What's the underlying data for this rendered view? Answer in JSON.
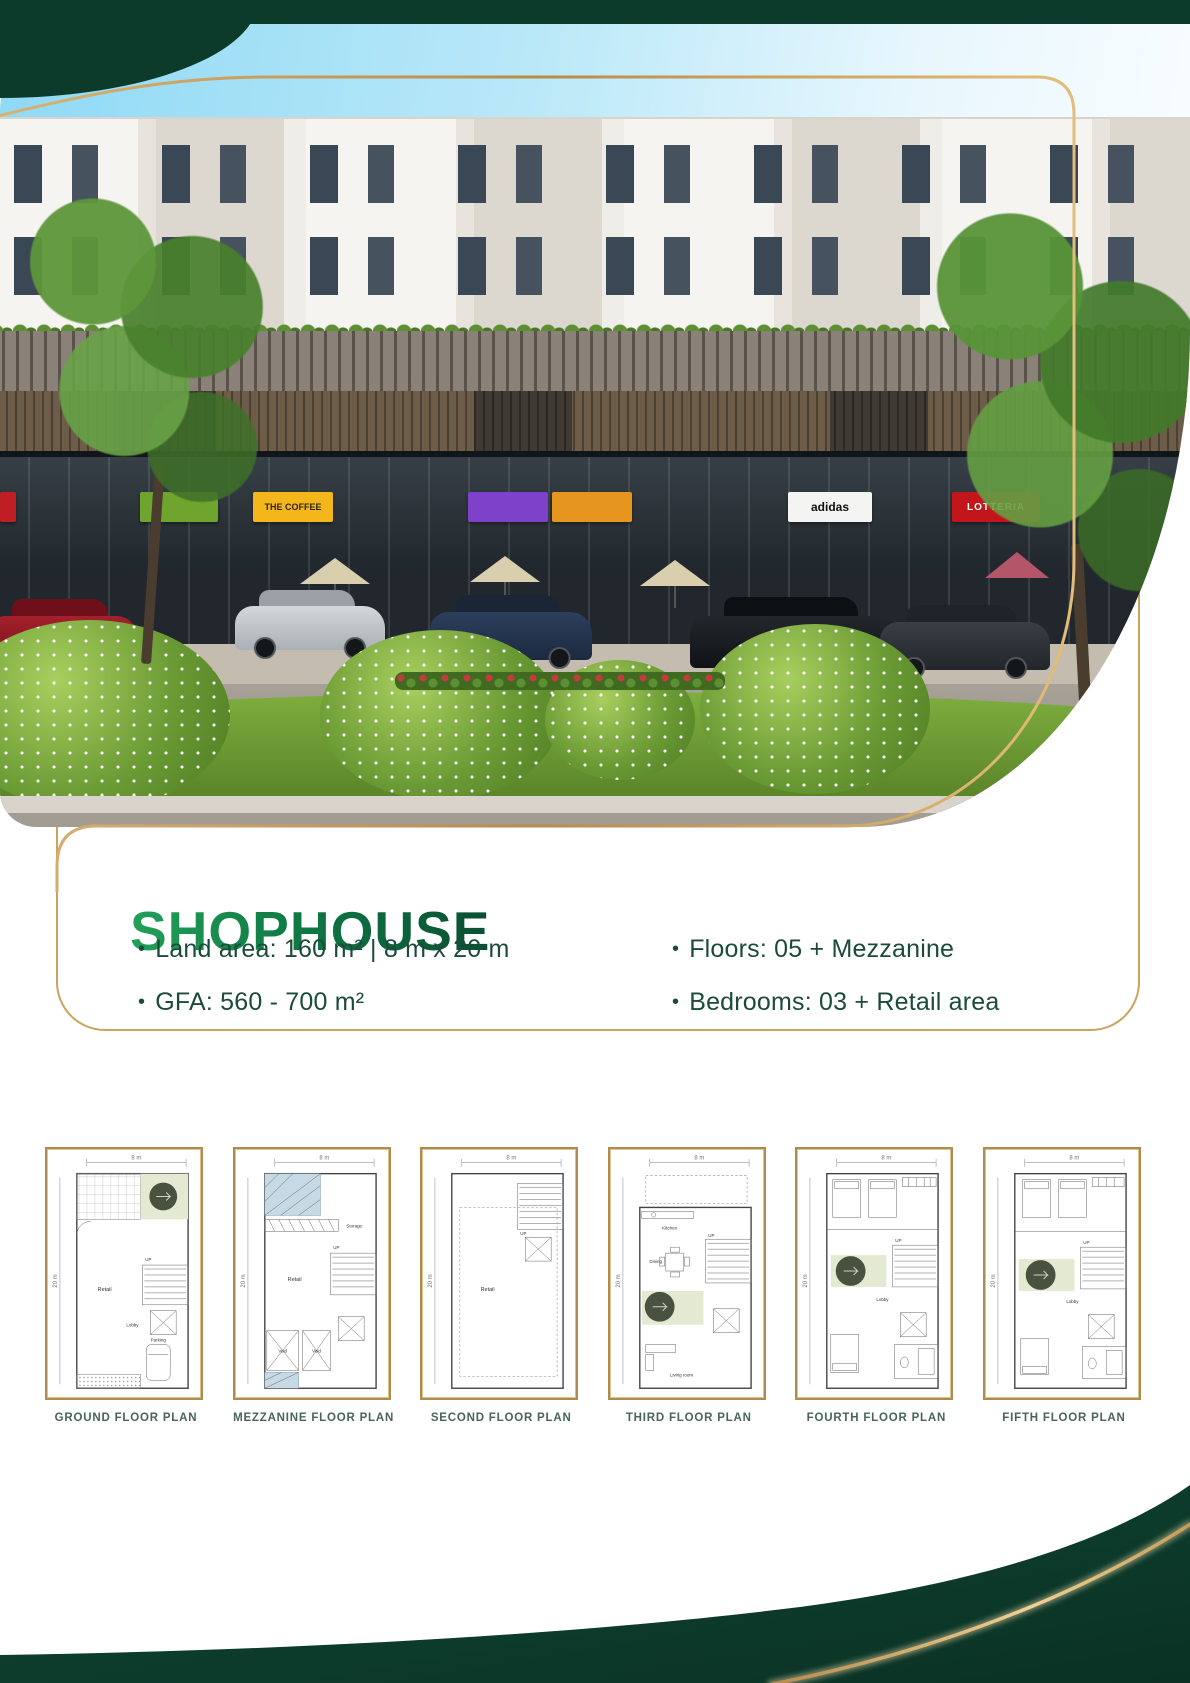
{
  "header": {
    "title": "SHOPHOUSE",
    "bullet": "•",
    "specs_left": [
      {
        "label": "Land area: 160 m² | 8 m x 20 m"
      },
      {
        "label": "GFA: 560 - 700 m²"
      }
    ],
    "specs_right": [
      {
        "label": "Floors: 05 + Mezzanine"
      },
      {
        "label": "Bedrooms: 03 + Retail area"
      }
    ]
  },
  "photo": {
    "signs": {
      "coffee": "THE COFFEE",
      "adidas": "adidas",
      "lotteria": "LOTTERIA"
    }
  },
  "colors": {
    "dark_green": "#0c3a2b",
    "gold": "#c99d5d",
    "title_green": "#0f7a44",
    "text_green": "#1c4a3b"
  },
  "plans": [
    {
      "caption": "GROUND FLOOR PLAN",
      "width_dim": "8 m",
      "depth_dim": "20 m",
      "labels": {
        "retail": "Retail",
        "lobby": "Lobby",
        "up": "UP",
        "parking": "Parking"
      }
    },
    {
      "caption": "MEZZANINE FLOOR PLAN",
      "width_dim": "8 m",
      "depth_dim": "20 m",
      "labels": {
        "retail": "Retail",
        "storage": "Storage",
        "up": "UP",
        "void1": "Void",
        "void2": "Void"
      }
    },
    {
      "caption": "SECOND FLOOR PLAN",
      "width_dim": "8 m",
      "depth_dim": "20 m",
      "labels": {
        "retail": "Retail",
        "up": "UP"
      }
    },
    {
      "caption": "THIRD FLOOR PLAN",
      "width_dim": "8 m",
      "depth_dim": "20 m",
      "labels": {
        "kitchen": "Kitchen",
        "dining": "Dining",
        "living": "Living room",
        "up": "UP"
      }
    },
    {
      "caption": "FOURTH FLOOR PLAN",
      "width_dim": "8 m",
      "depth_dim": "20 m",
      "labels": {
        "lobby": "Lobby",
        "up": "UP"
      }
    },
    {
      "caption": "FIFTH FLOOR PLAN",
      "width_dim": "8 m",
      "depth_dim": "20 m",
      "labels": {
        "lobby": "Lobby",
        "up": "UP"
      }
    }
  ]
}
